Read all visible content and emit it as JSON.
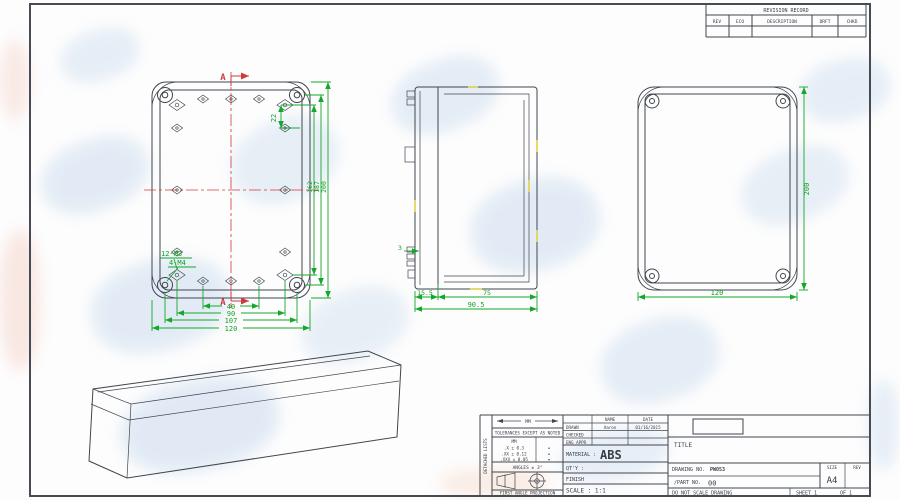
{
  "colors": {
    "dimension_green": "#14a82a",
    "centerline_red": "#cf3a3a",
    "line_dark": "#40454d",
    "watermark_blue": "#bcd2ea"
  },
  "revision_table": {
    "title": "REVISION RECORD",
    "col_rev": "REV",
    "col_eco": "ECO",
    "col_description": "DESCRIPTION",
    "col_drft": "DRFT",
    "col_chkd": "CHKD"
  },
  "views": {
    "front": {
      "section_marker": "A",
      "dim_boss_offset": "22",
      "dim_inner_height": "162",
      "dim_screw_height": "187",
      "dim_height": "200",
      "dim_holes_w": "40",
      "dim_boss_w": "90",
      "dim_screw_w": "107",
      "dim_width": "120",
      "label_m3": "12-M3",
      "label_m4": "4-M4"
    },
    "side": {
      "dim_tab": "3",
      "dim_lid": "15.5",
      "dim_body": "75",
      "dim_total": "90.5"
    },
    "back": {
      "dim_height": "200",
      "dim_width": "120"
    }
  },
  "title_block": {
    "side_label": "DETACHED LISTS",
    "units_symbol": "MM",
    "tolerance_note": "TOLERANCES EXCEPT AS NOTED",
    "tolerances": {
      "header": "MM",
      "rows": [
        ".X ± 0.3",
        ".XX ± 0.12",
        ".XXX ± 0.05"
      ],
      "dot": "•"
    },
    "angles": "ANGLES ± 3°",
    "projection": "FIRST ANGLE PROJECTION",
    "name_header": "NAME",
    "date_header": "DATE",
    "drawn_label": "DRAWN",
    "drawn_name": "Aaron",
    "drawn_date": "01/16/2015",
    "checked_label": "CHECKED",
    "eng_appr_label": "ENG APPR",
    "material_label": "MATERIAL :",
    "material_value": "ABS",
    "qty_label": "QT'Y :",
    "finish_label": "FINISH",
    "scale_label": "SCALE : 1:1",
    "title_label": "TITLE",
    "drawing_no_label": "DRAWING NO.",
    "drawing_no_value": "PW053",
    "part_no_label": "/PART NO.",
    "part_no_value": "00",
    "size_label": "SIZE",
    "size_value": "A4",
    "rev_label": "REV",
    "do_not_scale": "DO NOT SCALE DRAWING",
    "sheet_label": "SHEET 1",
    "of_label": "OF 1"
  }
}
